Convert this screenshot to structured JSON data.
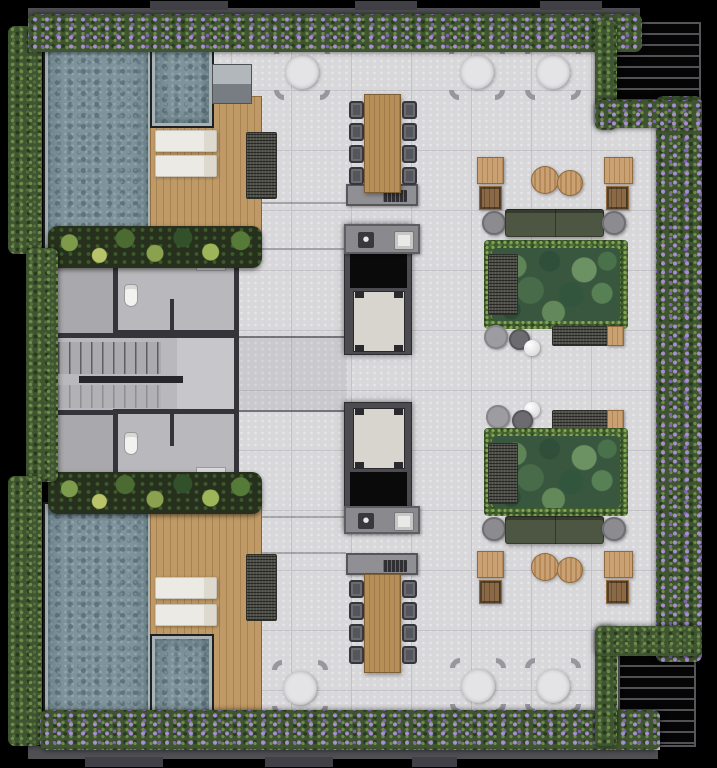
{
  "meta": {
    "title": "Rooftop amenity terrace floor plan",
    "view": "top-down architectural render",
    "canvas": {
      "width": 717,
      "height": 768
    },
    "visible_text": "none"
  },
  "palette": {
    "bg": "#000000",
    "wall-band": "#4f4f54",
    "wall-tab": "#404046",
    "wall-dark": "#34343a",
    "tile": "#d8d8db",
    "tile-joint": "#c2c2c7",
    "interior-floor": "#b9b9bd",
    "vestibule": "#c7c7cb",
    "concrete-path": "#a9a9ad",
    "hedge-green": "#3f5531",
    "hedge-light": "#6f8c49",
    "hedge-dark": "#263a1c",
    "flower-purple": "#a98fd2",
    "flower-deep": "#8165b2",
    "pool-water": "#7e939b",
    "pool-speckle": "#5e747d",
    "pool-rim": "#a9b2b4",
    "deck-wood": "#c09a66",
    "deck-groove": "#a8834f",
    "table-wood": "#b58e58",
    "rattan": "#4e4e49",
    "sofa-green": "#4c5643",
    "grass-green": "#3f5c31",
    "leaf-green": "#39573f",
    "pouf-wood": "#c9a173",
    "metal-gray": "#97979d",
    "chair-charcoal": "#55555c",
    "counter-gray": "#909094",
    "core-gray": "#4b4b50",
    "shaft-black": "#0a0a0b",
    "elevator-cab": "#d8d5ce",
    "lounger-white": "#eceae5",
    "louver-slat": "#515156",
    "side-table-gray": "#8c8c90",
    "sink-white": "#e9e9e7"
  },
  "inventory": {
    "main_pools": 2,
    "spa_pools": 2,
    "wood_decks": 2,
    "sun_loungers": 4,
    "tropical_planter_strips": 2,
    "grill_stations": 1,
    "rattan_daybeds": 2,
    "round_dining_tables": 6,
    "curved_chairs_per_round_table": 4,
    "communal_dining_tables": 2,
    "dining_chairs": 16,
    "bbq_counters": 2,
    "kitchen_islands_with_sink": 2,
    "elevator_cabs": 2,
    "elevator_shafts": 2,
    "stair_flights": 2,
    "restrooms": 2,
    "toilets": 2,
    "sofas": 2,
    "sofa_side_tables": 4,
    "green_planter_islands": 2,
    "rattan_lounge_chairs": 2,
    "rattan_benches": 2,
    "cafe_tables": 4,
    "wood_poufs": 4,
    "gray_poufs": 2,
    "dark_poufs": 2,
    "white_sphere_decor": 2,
    "louver_canopies": 2,
    "flowering_hedges": "perimeter top, bottom, right and two corner L-shapes",
    "plain_hedges": "left edge, three sections"
  }
}
